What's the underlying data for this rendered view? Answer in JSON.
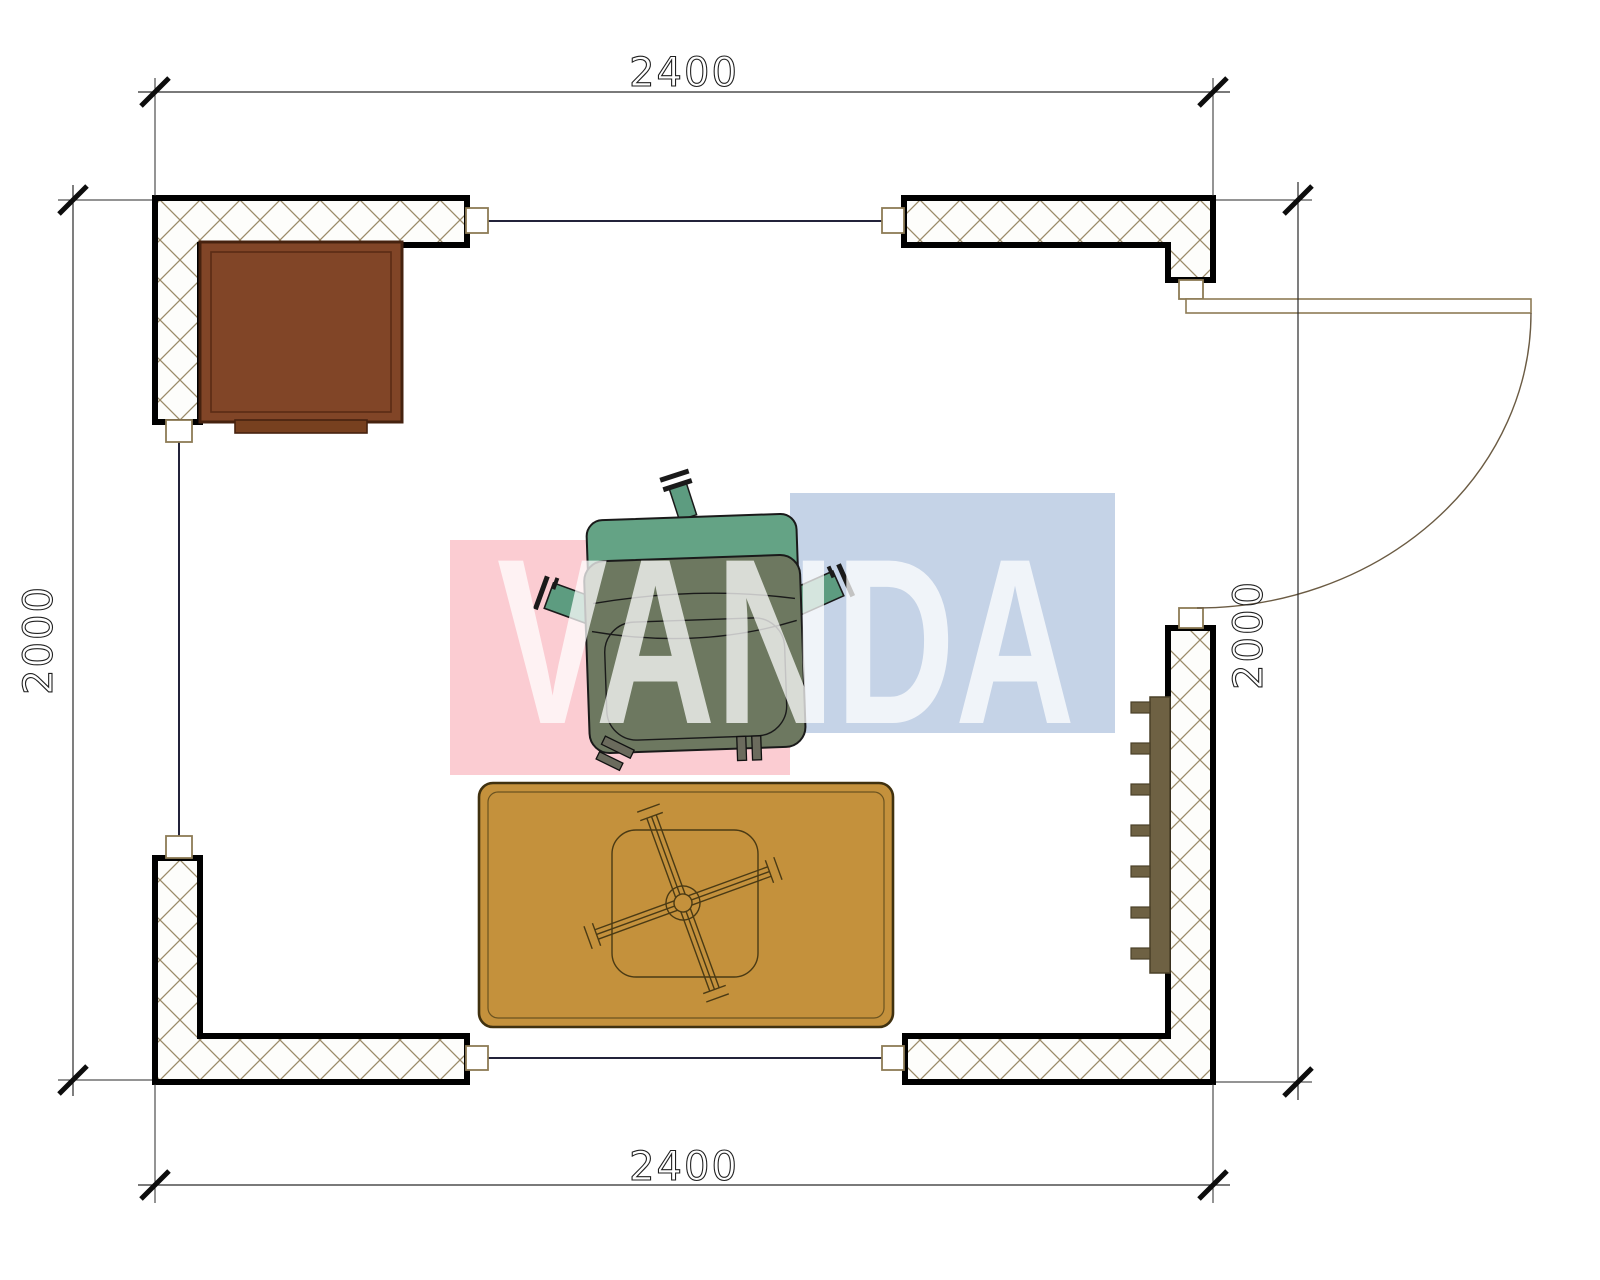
{
  "drawing": {
    "type": "architectural-floor-plan",
    "room": {
      "width_mm": 2400,
      "depth_mm": 2000
    },
    "dimensions": {
      "top": "2400",
      "bottom": "2400",
      "left": "2000",
      "right": "2000"
    },
    "watermark": {
      "text": "VANDA",
      "pink_color": "#fbccd2",
      "blue_color": "#c5d3e7",
      "text_color": "#ffffff"
    },
    "colors": {
      "wall_outline": "#000000",
      "wall_hatch": "#9a8a68",
      "window_line": "#23233a",
      "connector_outline": "#8d7b55",
      "desk": "#814527",
      "desk_outline": "#46220f",
      "rug": "#c4913c",
      "rug_outline": "#40310f",
      "chair_seat": "#6d7860",
      "chair_back": "#64a385",
      "chair_arm": "#5d9c80",
      "radiator": "#6e6143",
      "door_frame": "#8d7b55",
      "door_arc": "#6b5b43",
      "dimension_text": "#1f1f1f"
    },
    "furniture": [
      {
        "name": "desk"
      },
      {
        "name": "armchair"
      },
      {
        "name": "rug-with-folding-table"
      },
      {
        "name": "radiator"
      },
      {
        "name": "door"
      }
    ]
  }
}
